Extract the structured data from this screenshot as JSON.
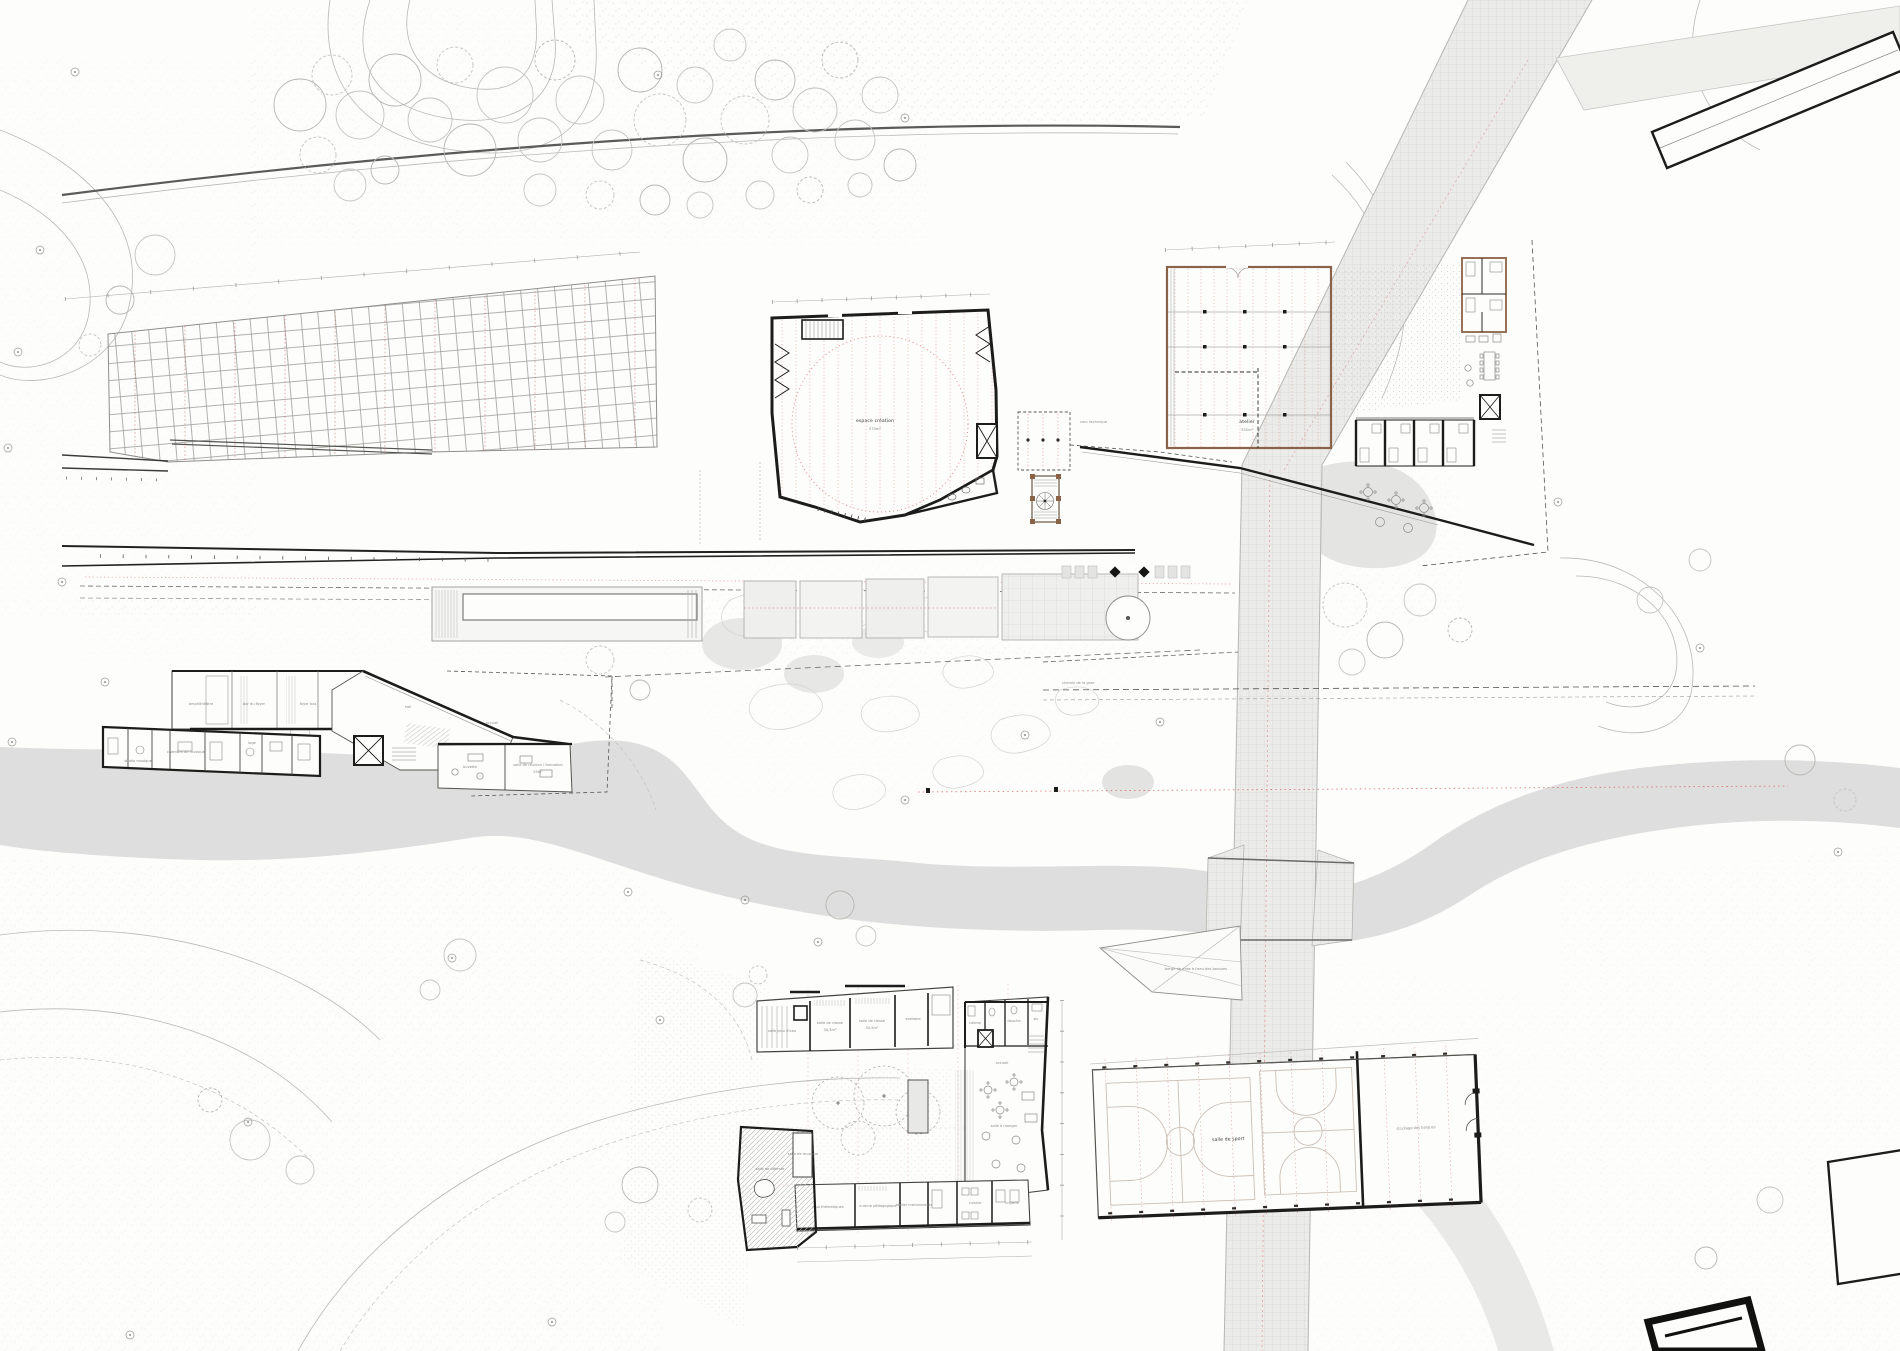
{
  "colors": {
    "paper": "#fdfdfc",
    "ink": "#1c1c1a",
    "red_dash": "#cf5148",
    "wood_wall": "#8a6247",
    "water": "#dedede",
    "road": "#ececea"
  },
  "labels": {
    "creation_hall": {
      "name": "espace création",
      "area": "570m²"
    },
    "cour_technique": "cour technique",
    "atelier": {
      "name": "atelier",
      "area": "555m²"
    },
    "walkway": "chemin de la gare",
    "deck": "berge de mise à l'eau des barques",
    "sports": {
      "main": "salle de sport",
      "storage": "stockage des barques"
    },
    "culture": {
      "amphi": "amphithéâtre",
      "bar": "bar du foyer",
      "foyer_bas": "foyer bas",
      "hall": "hall",
      "accueil": "accueil",
      "studio": "studio musique",
      "chambre": "chambre de musique",
      "loge": "loge",
      "buvette": "buvette",
      "reunion": "salle de réunion / formation",
      "reunion_area": "55m²"
    },
    "school": {
      "jeux_eau": "salle jeux d'eau",
      "classe1": "salle de classe",
      "classe1_area": "34,5m²",
      "classe2": "salle de classe",
      "classe2_area": "34,5m²",
      "vestiaire": "vestiaire",
      "cabine": "cabine",
      "douche": "douche",
      "wc": "wc",
      "accueil": "accueil",
      "manger": "salle à manger",
      "detente": "salle de détente",
      "musique": "salle de musique",
      "jeux": "jeux thématiques",
      "cuisine_peda": "cuisine pédagogique",
      "marionnettes": "atelier marionnettes",
      "cuisine": "cuisine",
      "lingerie": "lingerie"
    }
  }
}
